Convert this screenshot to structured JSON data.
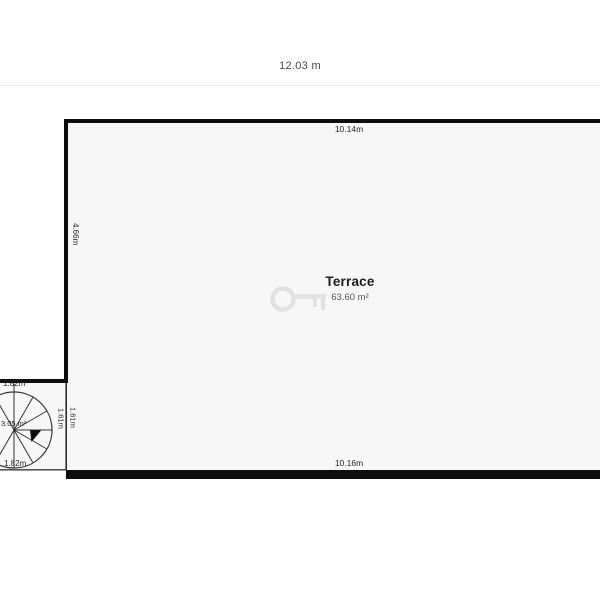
{
  "plan": {
    "overall_width_label": "12.03 m",
    "terrace": {
      "name": "Terrace",
      "area_label": "63.60 m²",
      "top_dimension": "10.14m",
      "bottom_dimension": "10.16m",
      "left_dimension": "4.66m"
    },
    "staircase": {
      "area_label": "3.05 m²",
      "top_dimension": "1.82m",
      "bottom_dimension": "1.82m",
      "inner_height_dimension": "1.61m",
      "outer_height_dimension": "1.61m"
    },
    "colors": {
      "wall": "#0e0e0e",
      "room_fill": "#f7f7f7",
      "divider": "#e8e8e8",
      "watermark": "#e1e1e1"
    },
    "icons": {
      "watermark": "key-watermark-icon"
    }
  }
}
